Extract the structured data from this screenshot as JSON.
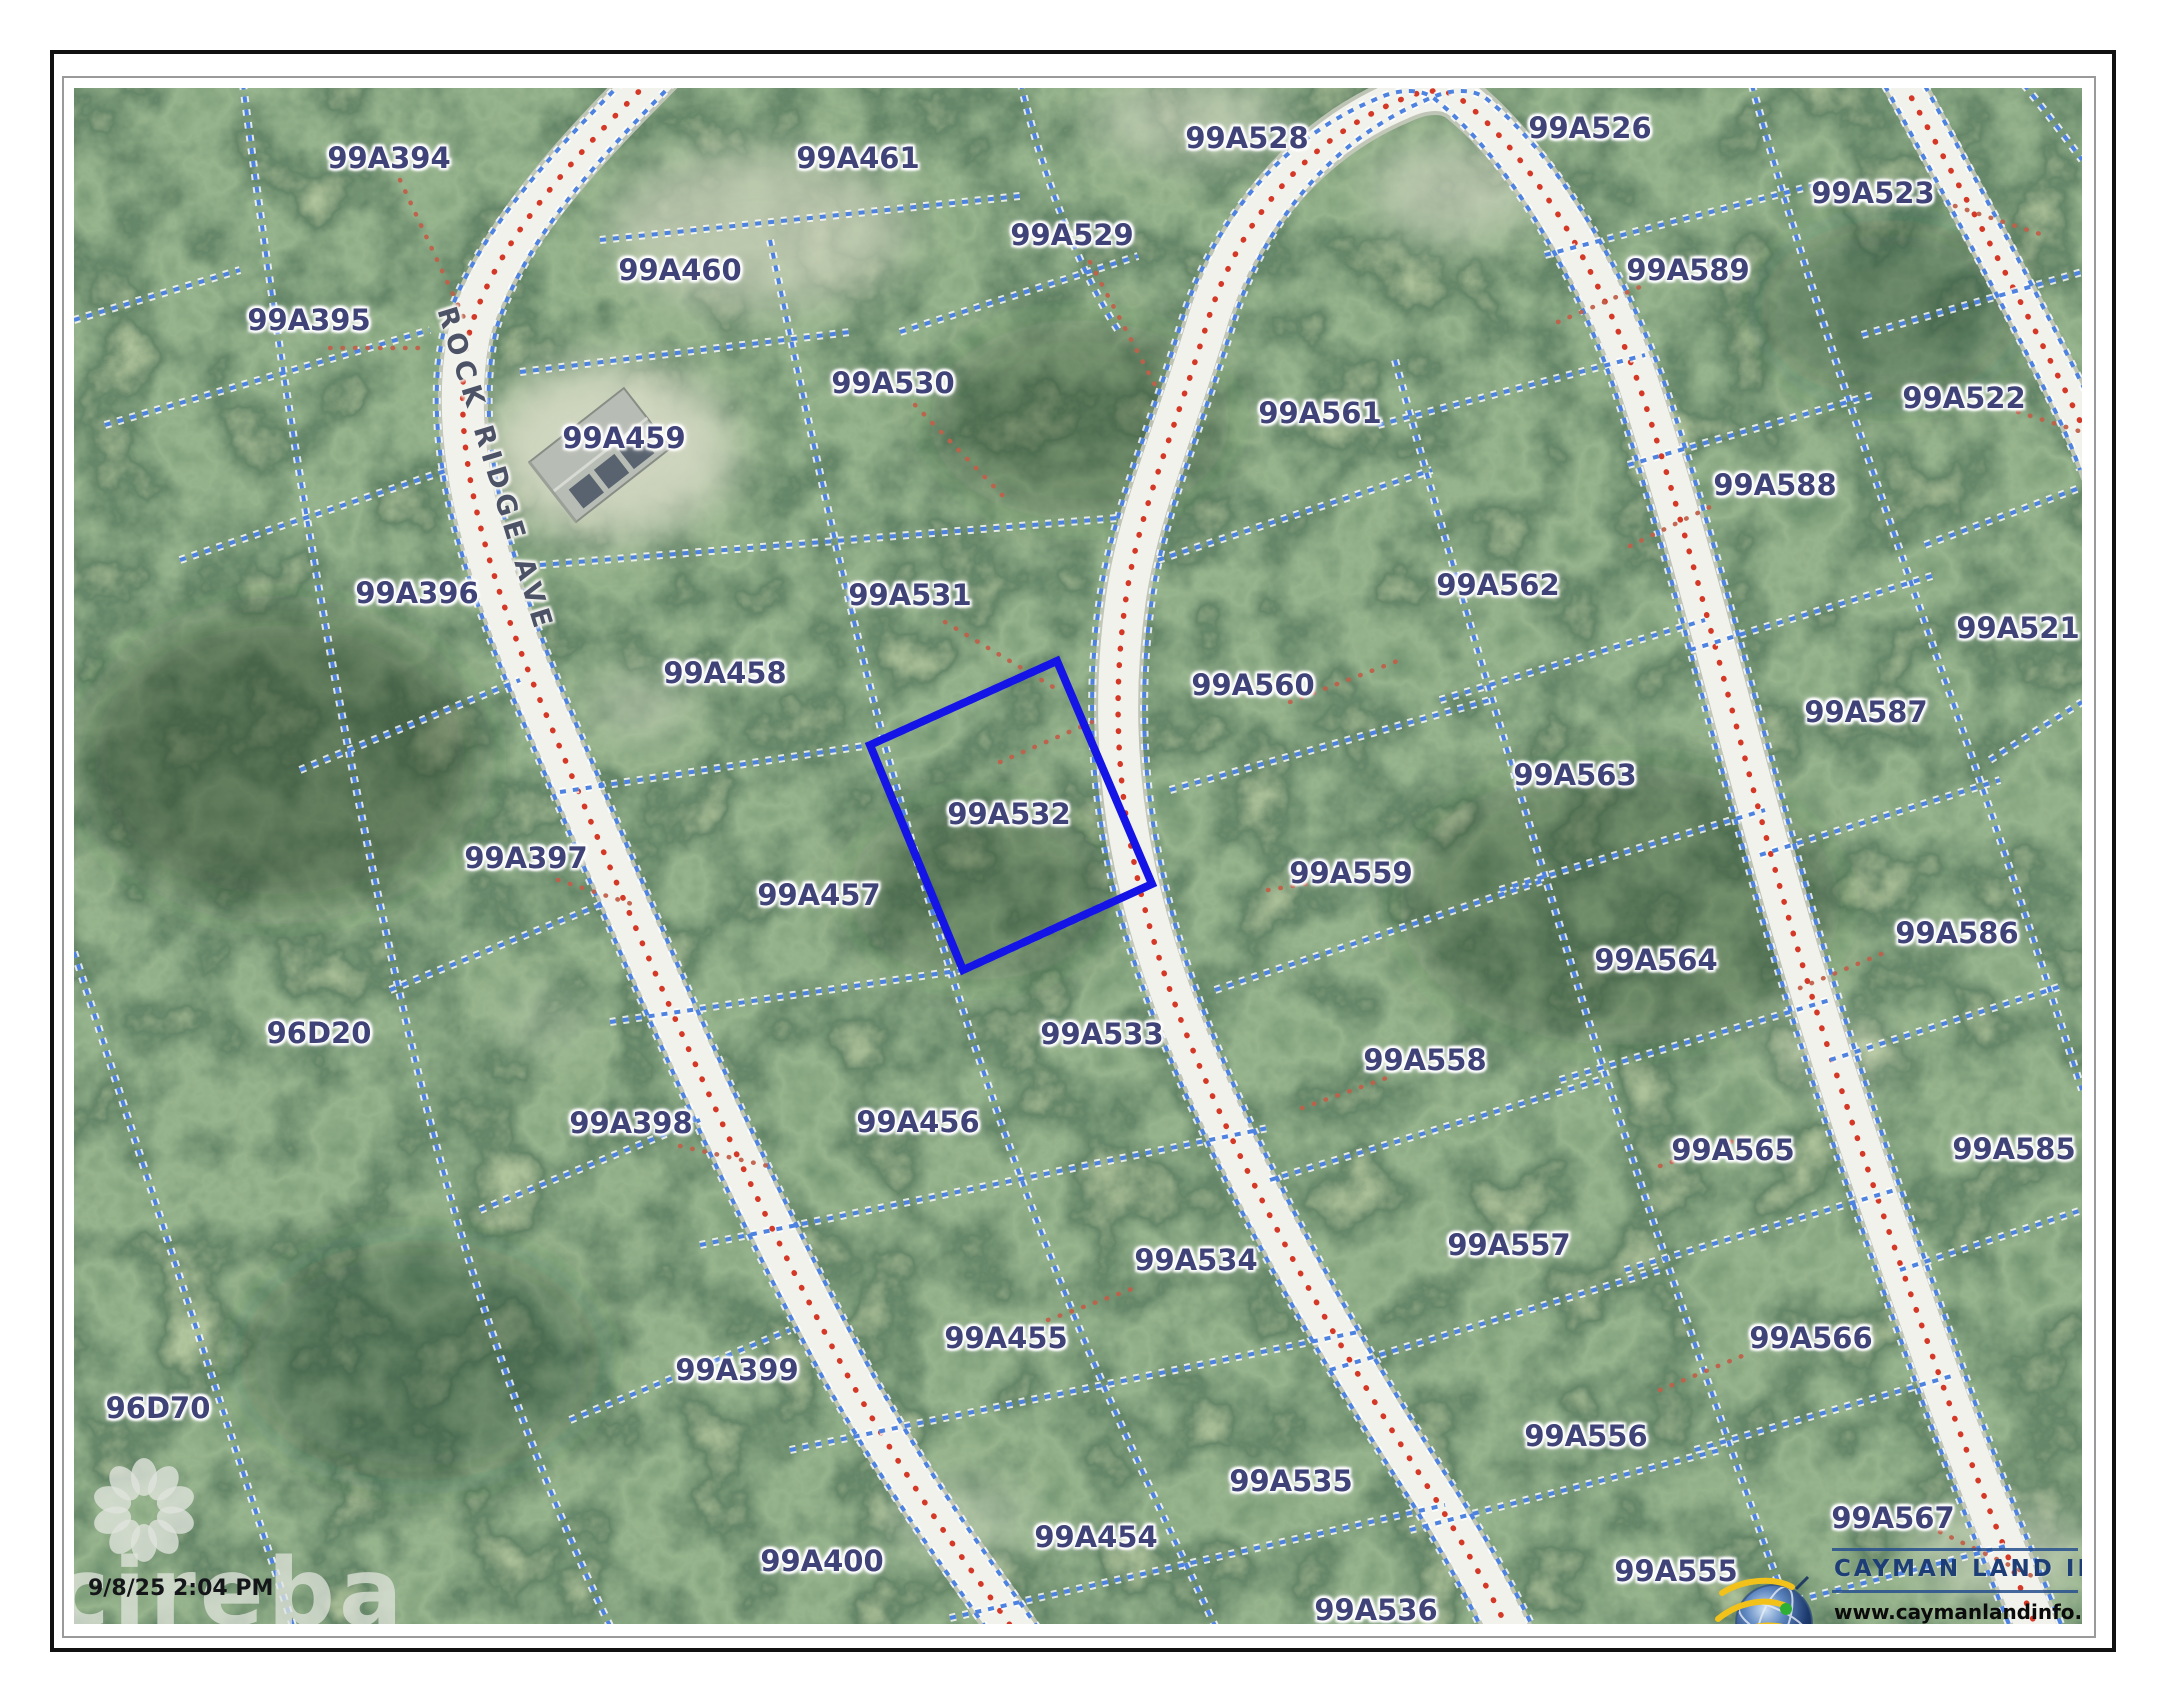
{
  "page": {
    "background": "#ffffff",
    "frame_color": "#111111",
    "inner_frame_color": "#9a9a9a"
  },
  "map": {
    "road_label": "ROCK RIDGE AVE",
    "boundary_color": "#4d82e0",
    "highlight_color": "#1414e6",
    "label_color": "#3f4377",
    "highlighted_parcel_id": "99A532",
    "parcels": [
      {
        "id": "99A394",
        "x": 389,
        "y": 158
      },
      {
        "id": "99A461",
        "x": 858,
        "y": 158
      },
      {
        "id": "99A528",
        "x": 1247,
        "y": 138
      },
      {
        "id": "99A526",
        "x": 1590,
        "y": 128
      },
      {
        "id": "99A523",
        "x": 1873,
        "y": 193
      },
      {
        "id": "99A395",
        "x": 309,
        "y": 320
      },
      {
        "id": "99A460",
        "x": 680,
        "y": 270
      },
      {
        "id": "99A529",
        "x": 1072,
        "y": 235
      },
      {
        "id": "99A589",
        "x": 1688,
        "y": 270
      },
      {
        "id": "99A459",
        "x": 624,
        "y": 438
      },
      {
        "id": "99A530",
        "x": 893,
        "y": 383
      },
      {
        "id": "99A561",
        "x": 1320,
        "y": 413
      },
      {
        "id": "99A522",
        "x": 1964,
        "y": 398
      },
      {
        "id": "99A588",
        "x": 1775,
        "y": 485
      },
      {
        "id": "99A396",
        "x": 417,
        "y": 593
      },
      {
        "id": "99A531",
        "x": 910,
        "y": 595
      },
      {
        "id": "99A562",
        "x": 1498,
        "y": 585
      },
      {
        "id": "99A521",
        "x": 2018,
        "y": 628
      },
      {
        "id": "99A458",
        "x": 725,
        "y": 673
      },
      {
        "id": "99A560",
        "x": 1253,
        "y": 685
      },
      {
        "id": "99A587",
        "x": 1866,
        "y": 712
      },
      {
        "id": "99A532",
        "x": 1009,
        "y": 814,
        "highlighted": true
      },
      {
        "id": "99A563",
        "x": 1575,
        "y": 775
      },
      {
        "id": "99A397",
        "x": 526,
        "y": 858
      },
      {
        "id": "99A457",
        "x": 819,
        "y": 895
      },
      {
        "id": "99A559",
        "x": 1351,
        "y": 873
      },
      {
        "id": "99A586",
        "x": 1957,
        "y": 933
      },
      {
        "id": "96D20",
        "x": 319,
        "y": 1033
      },
      {
        "id": "99A564",
        "x": 1656,
        "y": 960
      },
      {
        "id": "99A533",
        "x": 1102,
        "y": 1034
      },
      {
        "id": "99A558",
        "x": 1425,
        "y": 1060
      },
      {
        "id": "99A398",
        "x": 631,
        "y": 1123
      },
      {
        "id": "99A456",
        "x": 918,
        "y": 1122
      },
      {
        "id": "99A565",
        "x": 1733,
        "y": 1150
      },
      {
        "id": "99A585",
        "x": 2014,
        "y": 1149
      },
      {
        "id": "99A534",
        "x": 1196,
        "y": 1260
      },
      {
        "id": "99A557",
        "x": 1509,
        "y": 1245
      },
      {
        "id": "99A455",
        "x": 1006,
        "y": 1338
      },
      {
        "id": "99A399",
        "x": 737,
        "y": 1370
      },
      {
        "id": "99A566",
        "x": 1811,
        "y": 1338
      },
      {
        "id": "96D70",
        "x": 158,
        "y": 1408
      },
      {
        "id": "99A556",
        "x": 1586,
        "y": 1436
      },
      {
        "id": "99A535",
        "x": 1291,
        "y": 1481
      },
      {
        "id": "99A567",
        "x": 1893,
        "y": 1518
      },
      {
        "id": "99A400",
        "x": 822,
        "y": 1561
      },
      {
        "id": "99A454",
        "x": 1096,
        "y": 1537
      },
      {
        "id": "99A555",
        "x": 1676,
        "y": 1571
      },
      {
        "id": "99A536",
        "x": 1376,
        "y": 1610
      }
    ]
  },
  "overlays": {
    "timestamp": "9/8/25 2:04 PM",
    "cireba_watermark": "cireba",
    "logo": {
      "title": "CAYMAN LAND INFO",
      "url": "www.caymanlandinfo.ky"
    }
  }
}
